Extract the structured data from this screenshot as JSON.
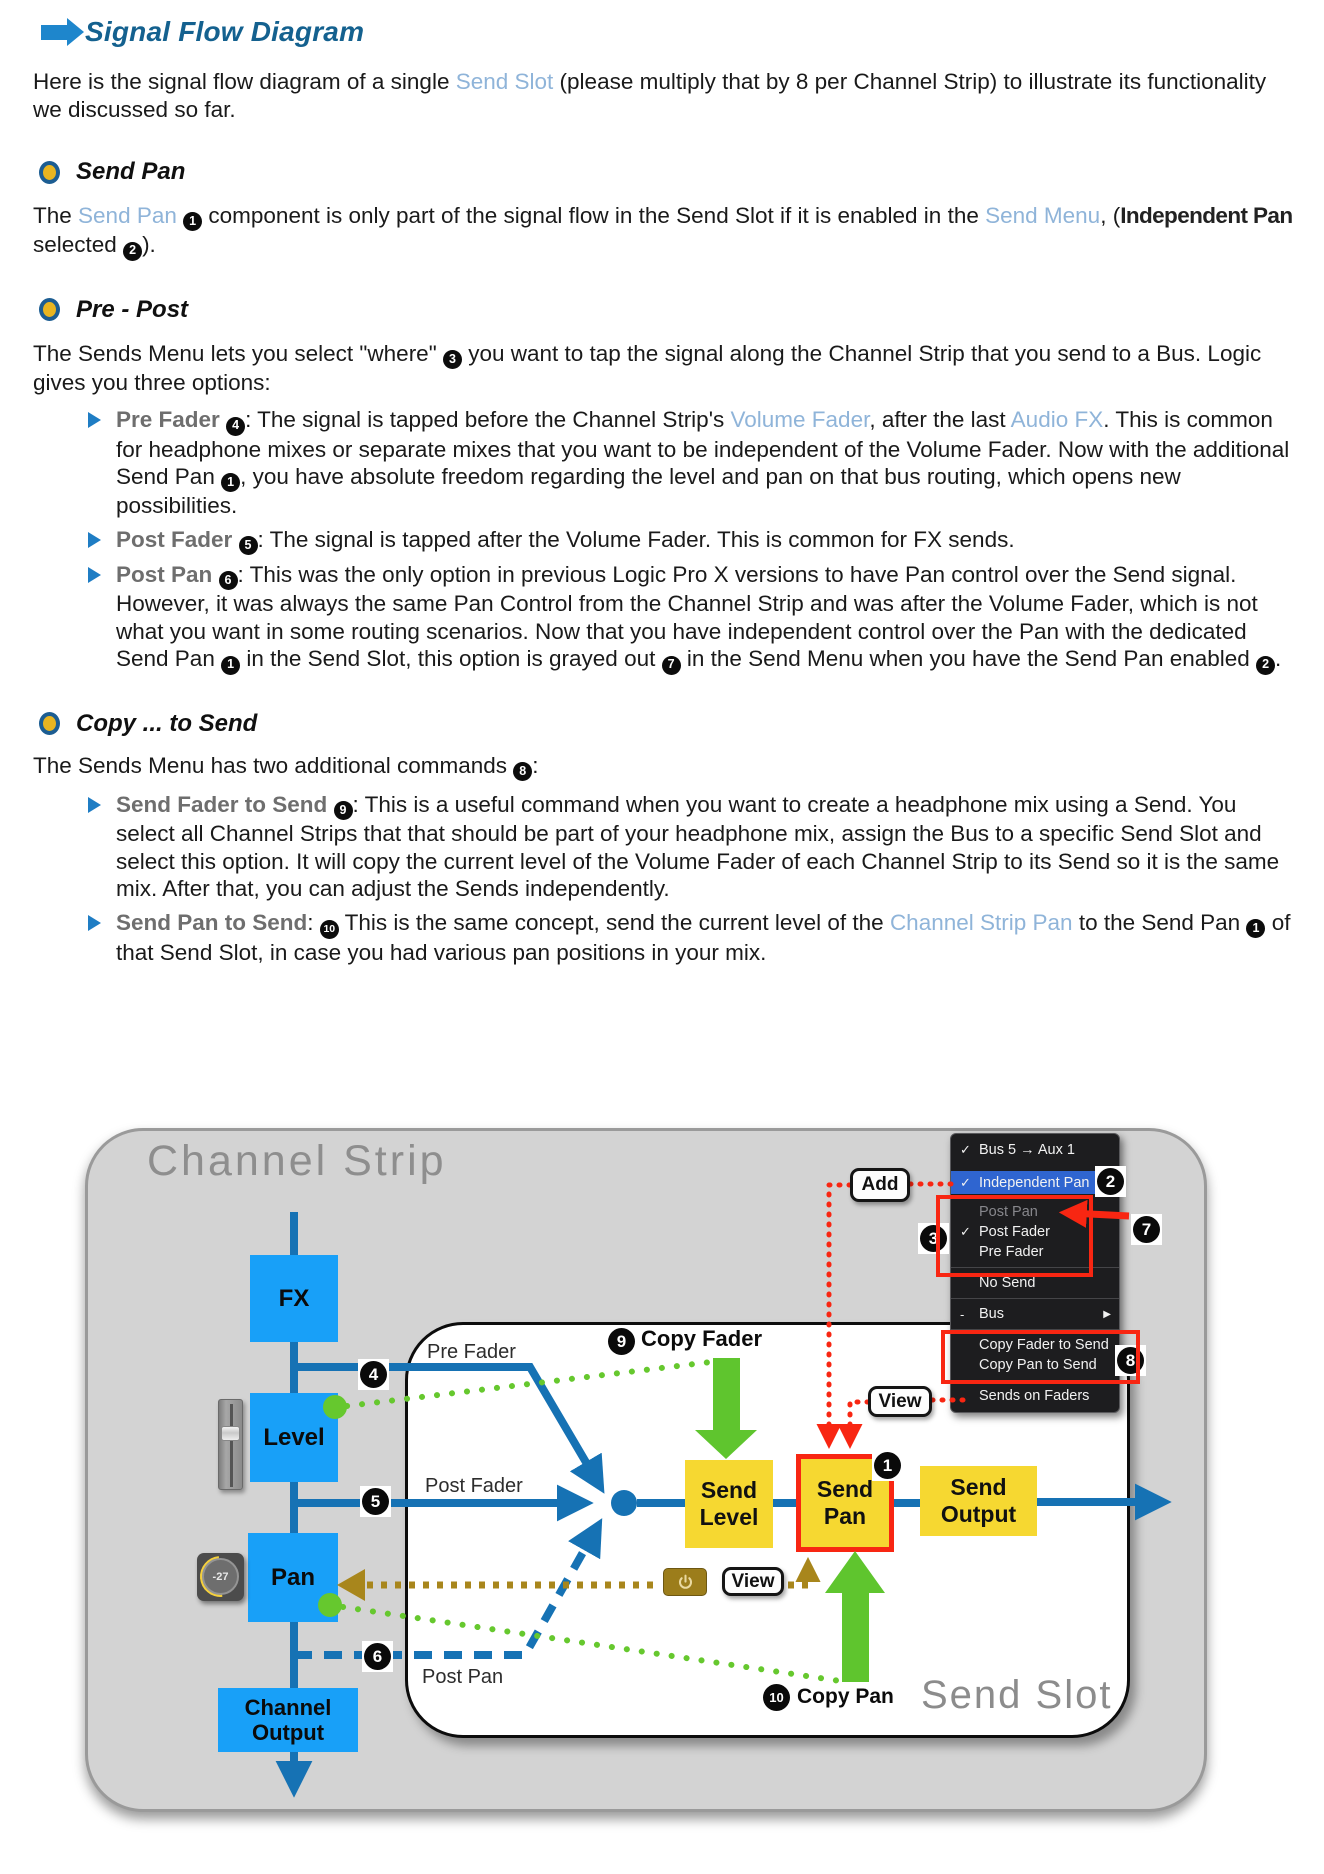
{
  "header": {
    "title": "Signal Flow Diagram"
  },
  "intro": {
    "t1": "Here is the signal flow diagram of a single ",
    "link_send_slot": "Send Slot",
    "t2": " (please multiply that by 8 per Channel Strip) to illustrate its functionality we discussed so far."
  },
  "send_pan": {
    "title": "Send Pan",
    "t1": "The ",
    "link_send_pan": "Send Pan",
    "b1": "1",
    "t2": " component is only part of the signal flow in the Send Slot if it is enabled in the ",
    "link_send_menu": "Send Menu",
    "t3": ", (",
    "cond": "Independent Pan",
    "t4": " selected ",
    "b2": "2",
    "t5": ")."
  },
  "pre_post": {
    "title": "Pre - Post",
    "t1": "The Sends Menu lets you select \"where\" ",
    "b3": "3",
    "t2": " you want to tap the signal along the Channel Strip that you send to a Bus. Logic gives you three options:",
    "bullet1": {
      "lead": "Pre Fader ",
      "badge": "4",
      "t1": ": The signal is tapped before the Channel Strip's ",
      "link1": "Volume Fader",
      "t2": ", after the last ",
      "link2": "Audio FX",
      "t3": ". This is common for headphone mixes or separate mixes that you want to be independent of the Volume Fader. Now with the additional Send Pan ",
      "badge2": "1",
      "t4": ", you have absolute freedom regarding the level and pan on that bus routing, which opens new possibilities."
    },
    "bullet2": {
      "lead": "Post Fader ",
      "badge": "5",
      "t1": ": The signal is tapped after the Volume Fader. This is common for FX sends."
    },
    "bullet3": {
      "lead": "Post Pan ",
      "badge": "6",
      "t1": ": This was the only option in previous Logic Pro X versions to have Pan control over the Send signal. However, it was always the same Pan Control from the Channel Strip and was after the Volume Fader, which is not what you want in some routing scenarios. Now that you have independent control over the Pan with the dedicated Send Pan ",
      "badge2": "1",
      "t2": " in the Send Slot, this option is grayed out ",
      "badge3": "7",
      "t3": " in the Send Menu when you have the Send Pan enabled ",
      "badge4": "2",
      "t4": "."
    }
  },
  "copy_send": {
    "title": "Copy ... to Send",
    "t1": "The Sends Menu has two additional commands ",
    "b8": "8",
    "t2": ":",
    "bullet1": {
      "lead": "Send Fader to Send ",
      "badge": "9",
      "t1": ": This is a useful command when you want to create a headphone mix using a Send. You select all Channel Strips that that should be part of your headphone mix, assign the Bus to a specific Send Slot and select this option. It will copy the current level of the Volume Fader of each Channel Strip to its Send so it is the same mix. After that, you can adjust the Sends independently."
    },
    "bullet2": {
      "lead": "Send Pan to Send",
      "t0": ": ",
      "badge": "10",
      "t1": " This is the same concept, send the current level of the ",
      "link1": "Channel Strip Pan",
      "t2": " to the Send Pan ",
      "badge2": "1",
      "t3": " of that Send Slot, in case you had various pan positions in your mix."
    }
  },
  "diagram": {
    "channel_strip_title": "Channel Strip",
    "send_slot_title": "Send Slot",
    "boxes": {
      "fx": "FX",
      "level": "Level",
      "pan": "Pan",
      "channel_output": "Channel Output",
      "send_level": "Send Level",
      "send_pan": "Send Pan",
      "send_output": "Send Output"
    },
    "labels": {
      "pre_fader": "Pre Fader",
      "post_fader": "Post Fader",
      "post_pan": "Post Pan",
      "copy_fader": "Copy Fader",
      "copy_pan": "Copy Pan"
    },
    "buttons": {
      "add": "Add",
      "view": "View"
    },
    "knob_value": "-27",
    "badges": {
      "b1": "1",
      "b2": "2",
      "b3": "3",
      "b4": "4",
      "b5": "5",
      "b6": "6",
      "b7": "7",
      "b8": "8",
      "b9": "9",
      "b10": "10"
    },
    "menu": {
      "items": [
        {
          "check": "✓",
          "label": "Bus 5 → Aux 1"
        },
        {
          "check": "✓",
          "label": "Independent Pan"
        },
        {
          "check": "",
          "label": "Post Pan"
        },
        {
          "check": "✓",
          "label": "Post Fader"
        },
        {
          "check": "",
          "label": "Pre Fader"
        },
        {
          "check": "",
          "label": "No Send"
        },
        {
          "check": "-",
          "label": "Bus",
          "submenu": "▶"
        },
        {
          "check": "",
          "label": "Copy Fader to Send"
        },
        {
          "check": "",
          "label": "Copy Pan to Send"
        },
        {
          "check": "",
          "label": "Sends on Faders"
        }
      ]
    }
  },
  "colors": {
    "heading_blue": "#14618f",
    "link_blue": "#8fb4d9",
    "accent_arrow_blue": "#1e86cc",
    "bullet_gold": "#e9b520",
    "flow_blue": "#1672b4",
    "box_blue": "#18a0f8",
    "box_yellow": "#f6d831",
    "annotation_red": "#f82612",
    "annotation_green": "#6abe30",
    "annotation_gold": "#a8861c",
    "menu_bg": "#1d1d1f",
    "menu_highlight": "#2f65d0"
  }
}
